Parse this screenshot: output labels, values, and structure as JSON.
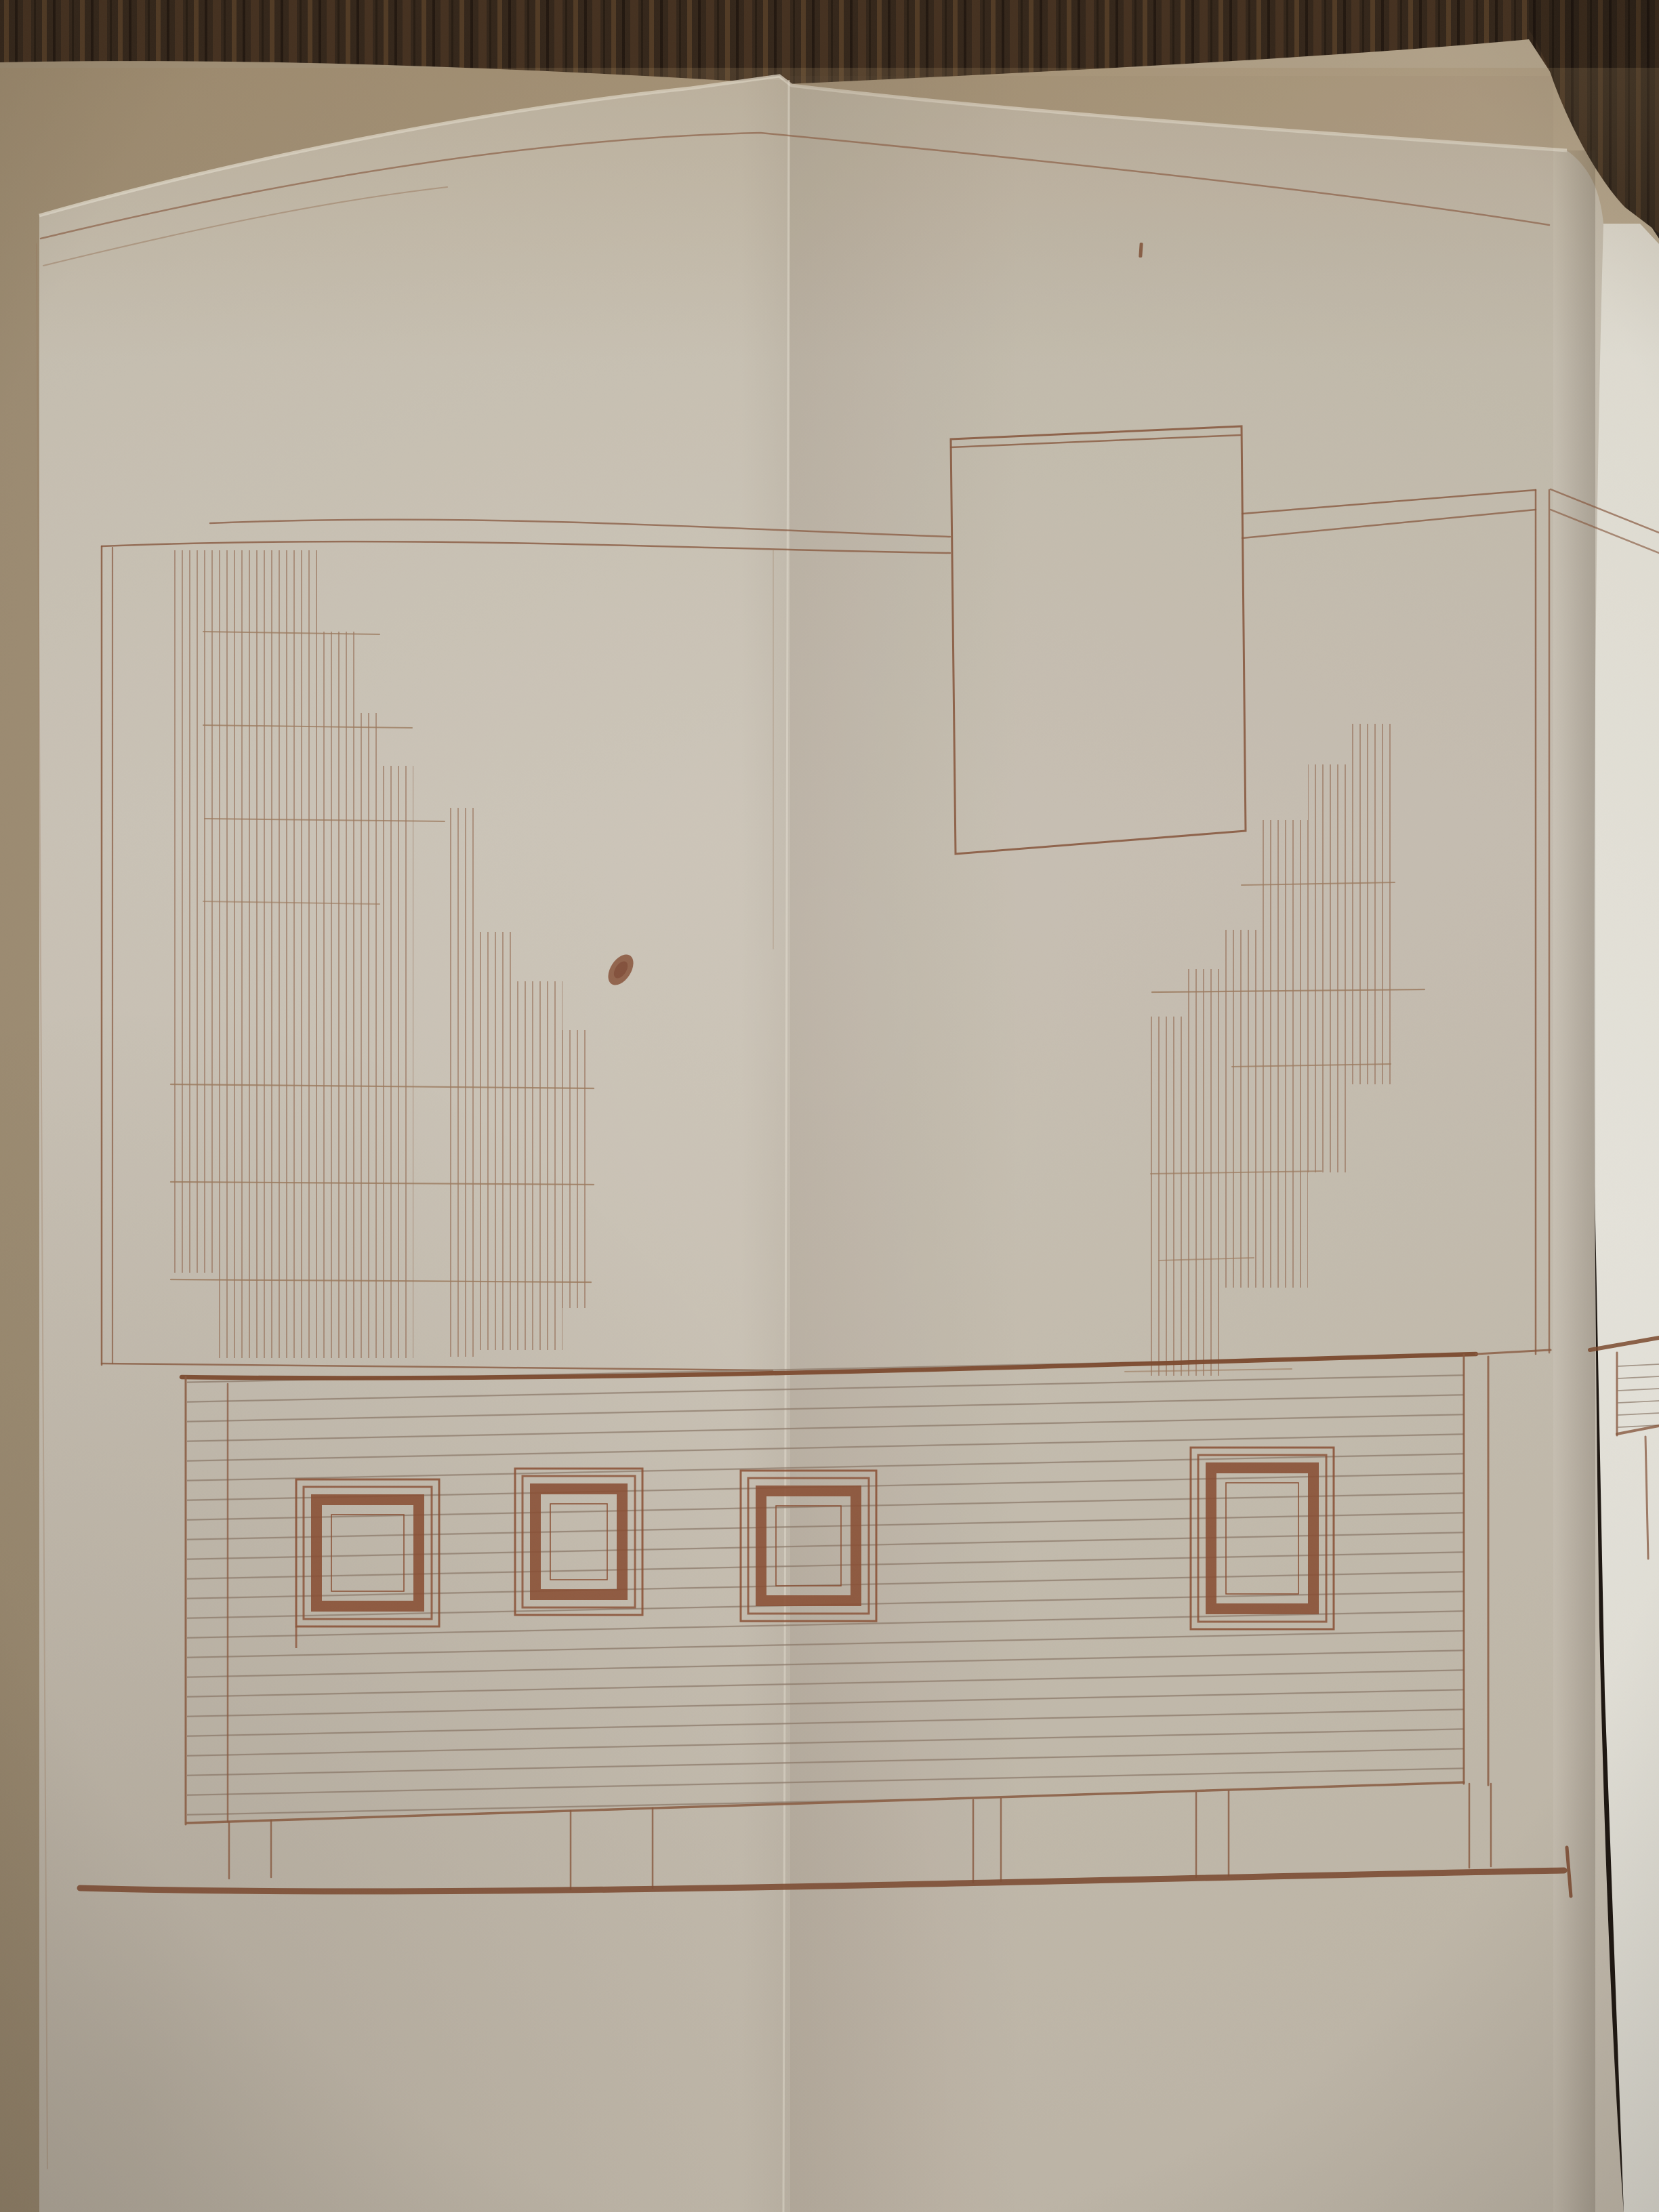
{
  "meta": {
    "description": "Photograph of an old hand-drawn architectural side-elevation in sepia ink on a cream sheet of folded drafting paper, lying on a dark wood table. A vertical fold crease runs down the center and the right edge of the sheet is folded over, showing a brighter strip of paper with a fragment of the same drawing.",
    "visible_text": "none"
  },
  "palette": {
    "wood_dark": "#34261a",
    "wood_streak": "#6f5030",
    "underlay_tan": "#a8987f",
    "underlay_tan_light": "#b9aa91",
    "paper_main": "#ccc5b8",
    "paper_bright": "#e8e5dc",
    "ink": "#8a5a40",
    "ink_strong": "#7c4a2e",
    "ink_faint": "#9c7a5e",
    "siding_line": "#8d7a6a",
    "window_frame": "#8a4f33",
    "ground_line": "#7e4e34",
    "blot": "#8d5a43"
  },
  "drawing": {
    "sheet": "cream drafting paper, arched top edge, vertical center fold crease, right edge folded over",
    "background": "dark wood table top visible above the sheet and in the top-right corner",
    "upper_left_block": {
      "type": "dense vertical hatching in stepped columns descending to the right",
      "columns": 10,
      "tie_lines": 7
    },
    "left_outline_rectangle": {
      "shape": "large open rectangle enclosing the upper-left hatching",
      "left_edge": "double line"
    },
    "roof_line": {
      "style": "long double horizontal line spanning the sheet",
      "interrupted_by": "chimney rectangle"
    },
    "chimney_rectangle": {
      "shape": "tall open rectangle crossing the roof line",
      "top_edge": "double line"
    },
    "upper_right_block": {
      "type": "vertical hatching in stepped columns rising to the right",
      "tie_lines": 6
    },
    "siding_band": {
      "style": "wide clapboard band of closely spaced horizontal lines",
      "clapboard_line_count": 22,
      "line_spacing_px": 29,
      "top_edge": "heavy line",
      "windows": 4
    },
    "windows": [
      {
        "position": "far left",
        "frame": "double outline with thick painted inner frame"
      },
      {
        "position": "center left",
        "frame": "double outline with thick painted inner frame"
      },
      {
        "position": "center, crossed by fold crease",
        "frame": "double outline with thick painted inner frame"
      },
      {
        "position": "right",
        "frame": "double outline with thick painted inner frame"
      }
    ],
    "foundation": {
      "tick_pairs": 5,
      "description": "short vertical pier marks between band bottom and ground line"
    },
    "ground_line": {
      "style": "single heavy horizontal base line with short vertical tick at right end"
    },
    "ink_blot": {
      "location": "blank area left of center, below the roof line"
    },
    "ink_speck": {
      "location": "small vertical dash above the chimney rectangle"
    },
    "right_fold_panel": {
      "content": "brighter folded-over strip showing roof double line and a clapboard-band fragment"
    }
  }
}
